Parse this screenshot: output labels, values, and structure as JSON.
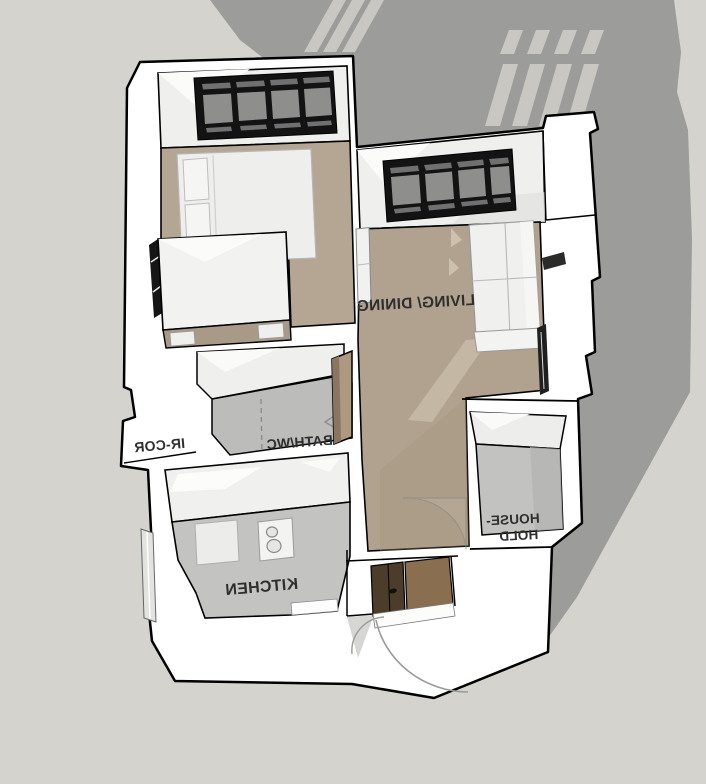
{
  "scene": {
    "type": "3d-axonometric-floor-plan-render",
    "description": "Monochrome 3D cutaway floor plan of a one-bedroom apartment casting a long gray shadow with window-light stripes; all room labels appear mirrored (view from behind/flipped)",
    "colors": {
      "background": "#d4d3cd",
      "cast_shadow": "#9c9c9a",
      "light_stripe": "#c8c7c2",
      "walls": "#ffffff",
      "wall_face": "#efefee",
      "outline": "#000000",
      "floor_tan": "#b2a391",
      "floor_gray": "#c3c3c1",
      "window_frame": "#131313",
      "window_glass": "#8e8e8c",
      "entry_door_brown": "#8a6e50",
      "entry_door_dark": "#4c3c2a",
      "bath_door_brown": "#ae9880",
      "label_text": "#2e2e2c"
    }
  },
  "rooms": {
    "living_dining": {
      "label": "LIVING/ DINING"
    },
    "bath_wc": {
      "label": "BATH/WC"
    },
    "kitchen": {
      "label": "KITCHEN"
    },
    "household": {
      "label_line1": "HOUSE-",
      "label_line2": "HOLD"
    },
    "corridor": {
      "label_partial": "IR-COR"
    }
  },
  "furniture": [
    "double-bed",
    "wardrobe",
    "sofa",
    "shelf",
    "kitchen-counter",
    "sink-cabinet",
    "cooktop",
    "entry-door",
    "bath-door",
    "door-swing-arcs",
    "windows"
  ]
}
